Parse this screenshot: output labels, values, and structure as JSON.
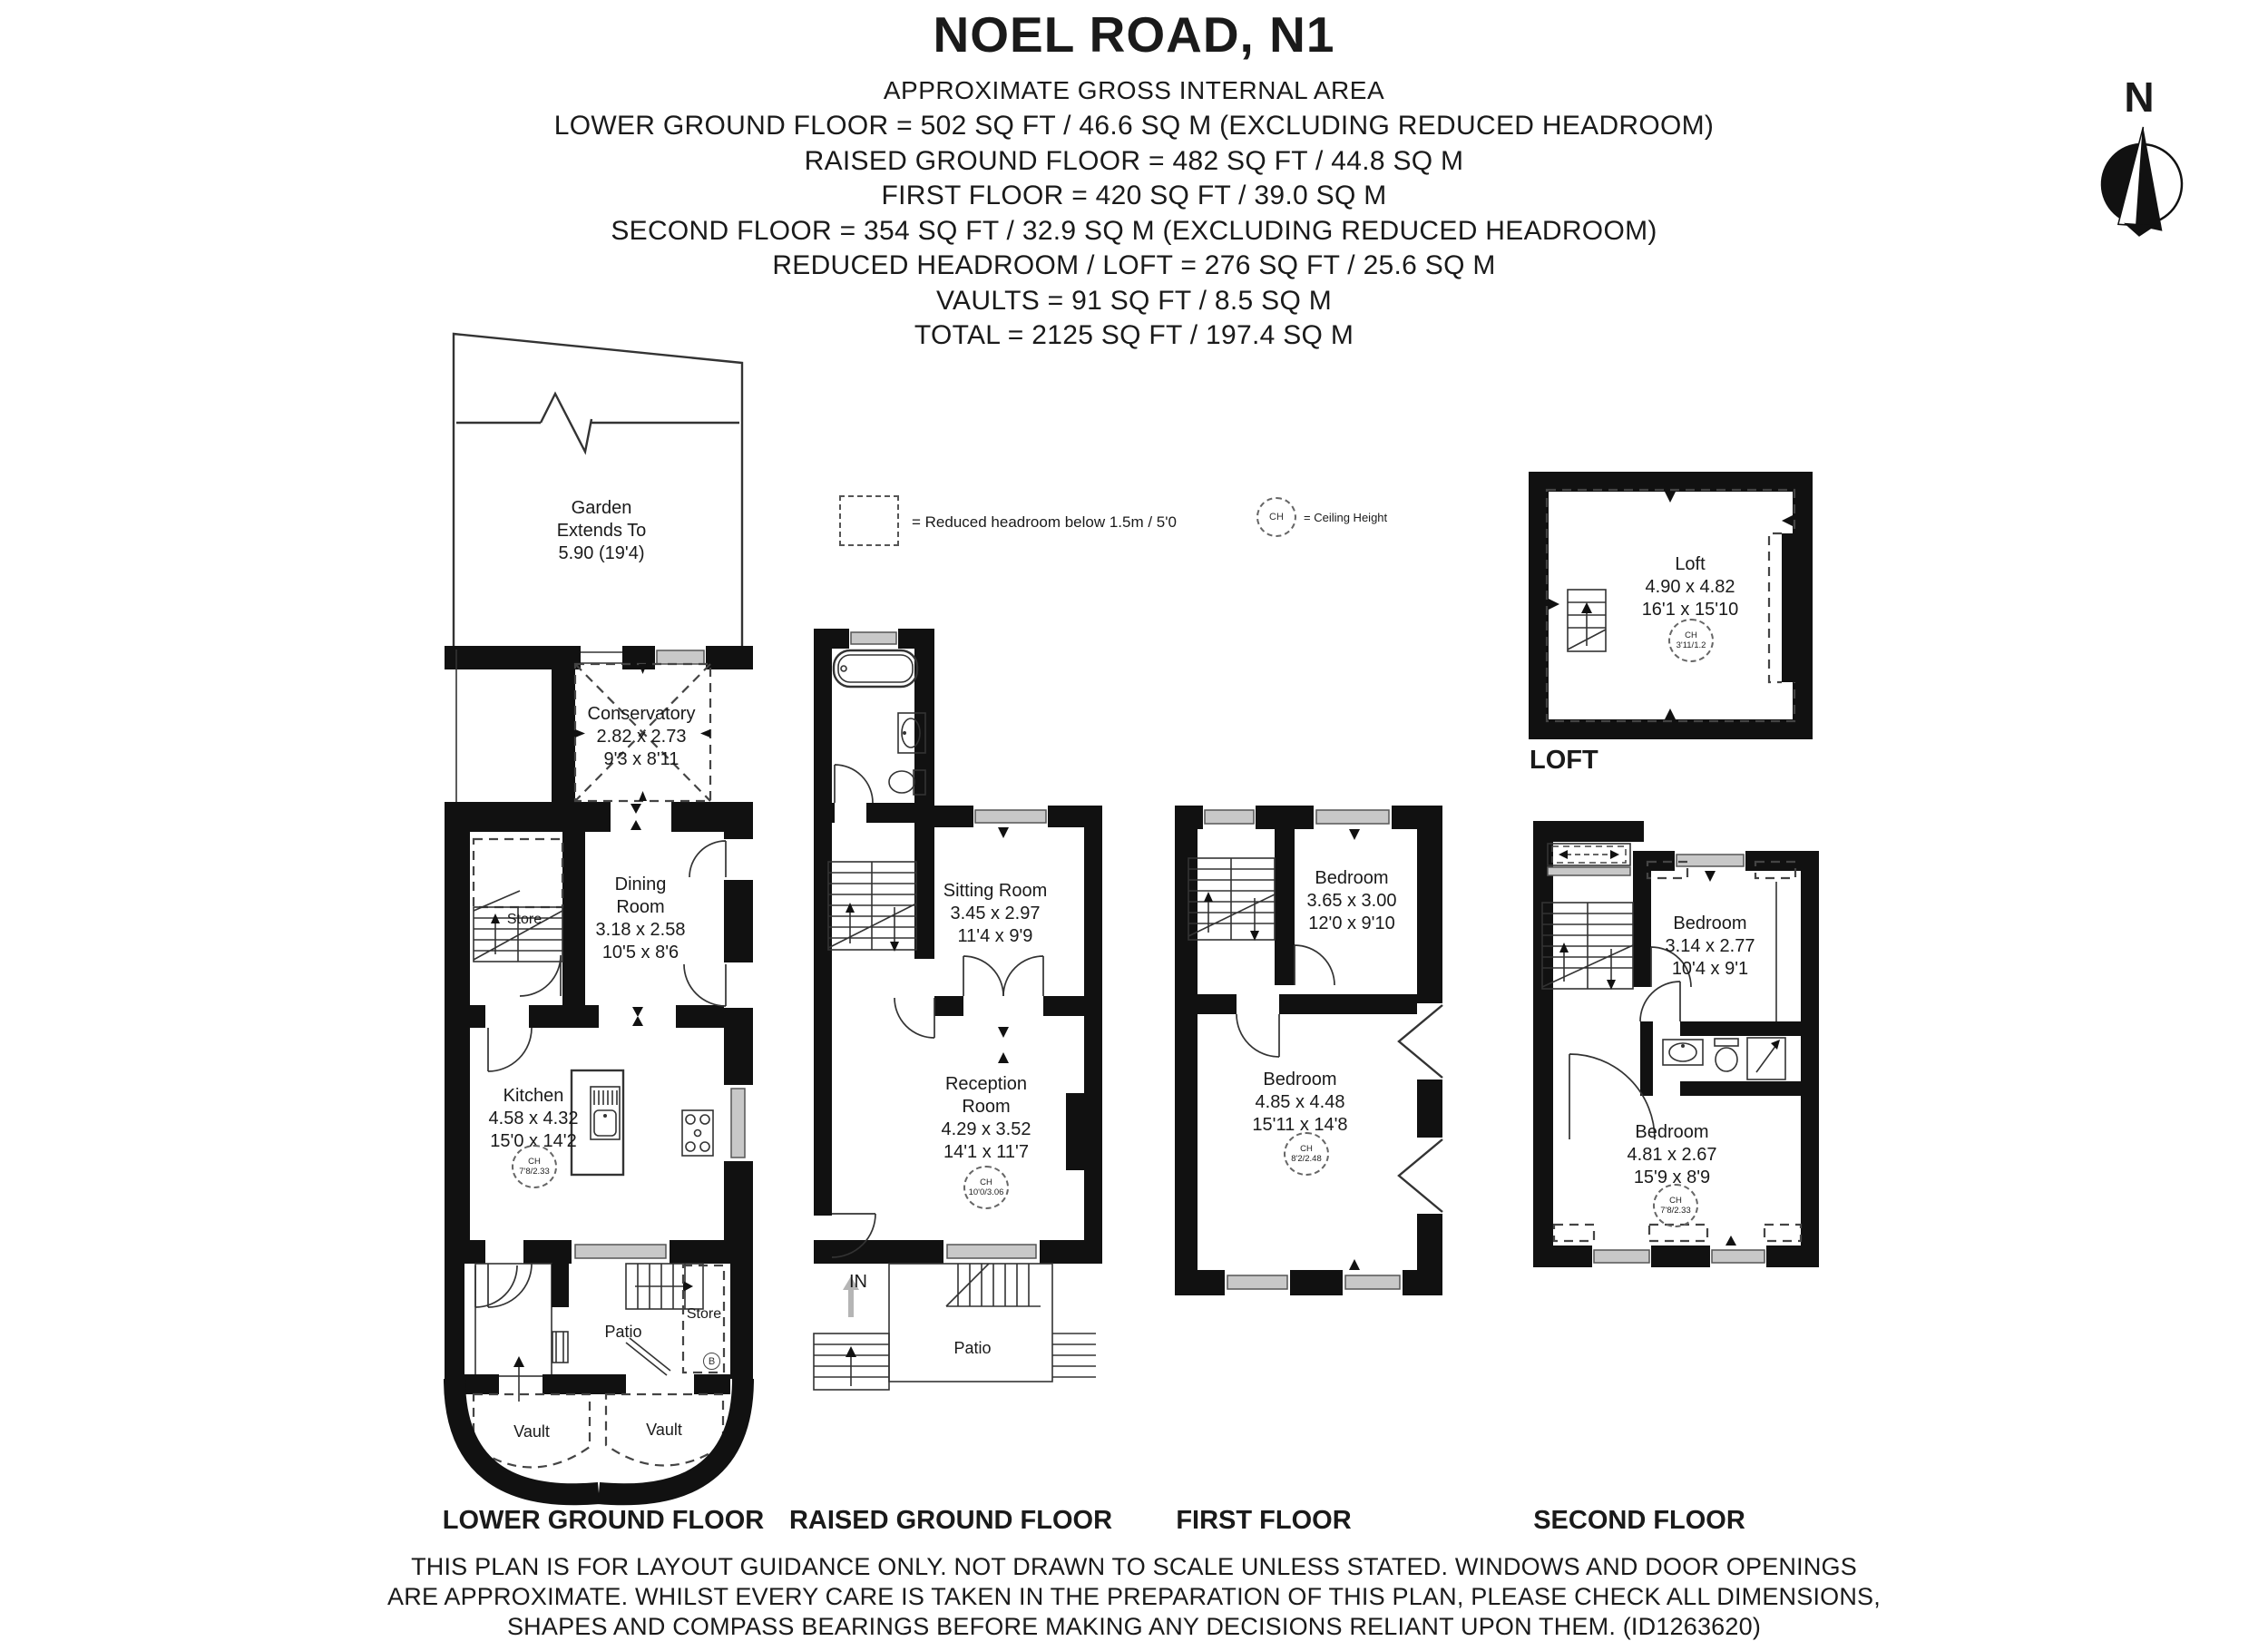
{
  "header": {
    "title": "NOEL ROAD, N1",
    "subtitle": "APPROXIMATE GROSS INTERNAL AREA",
    "lines": [
      "LOWER GROUND FLOOR = 502 SQ FT / 46.6 SQ M (EXCLUDING REDUCED HEADROOM)",
      "RAISED GROUND FLOOR = 482 SQ FT / 44.8 SQ M",
      "FIRST FLOOR = 420 SQ FT / 39.0 SQ M",
      "SECOND FLOOR = 354 SQ FT / 32.9 SQ M (EXCLUDING REDUCED HEADROOM)",
      "REDUCED HEADROOM / LOFT = 276 SQ FT / 25.6 SQ M",
      "VAULTS = 91 SQ FT / 8.5 SQ M",
      "TOTAL = 2125 SQ FT / 197.4 SQ M"
    ]
  },
  "compass": {
    "label": "N"
  },
  "legend": {
    "reduced_headroom": "= Reduced headroom below 1.5m / 5'0",
    "ch_abbr": "CH",
    "ceiling_height": "= Ceiling Height"
  },
  "lower_ground": {
    "floor_label": "LOWER GROUND FLOOR",
    "garden": {
      "line1": "Garden",
      "line2": "Extends To",
      "line3": "5.90 (19'4)"
    },
    "conservatory": {
      "name": "Conservatory",
      "metric": "2.82 x 2.73",
      "imperial": "9'3 x 8'11"
    },
    "dining": {
      "name1": "Dining",
      "name2": "Room",
      "metric": "3.18 x 2.58",
      "imperial": "10'5 x 8'6"
    },
    "store_upper": "Store",
    "kitchen": {
      "name": "Kitchen",
      "metric": "4.58 x 4.32",
      "imperial": "15'0 x 14'2",
      "ch": "7'8/2.33"
    },
    "patio": "Patio",
    "store_lower": "Store",
    "store_lower_badge": "B",
    "vault_left": "Vault",
    "vault_right": "Vault"
  },
  "raised_ground": {
    "floor_label": "RAISED GROUND FLOOR",
    "sitting": {
      "name": "Sitting Room",
      "metric": "3.45 x 2.97",
      "imperial": "11'4 x 9'9"
    },
    "reception": {
      "name1": "Reception",
      "name2": "Room",
      "metric": "4.29 x 3.52",
      "imperial": "14'1 x 11'7",
      "ch": "10'0/3.06"
    },
    "in_label": "IN",
    "patio": "Patio"
  },
  "first_floor": {
    "floor_label": "FIRST FLOOR",
    "bedroom_rear": {
      "name": "Bedroom",
      "metric": "3.65 x 3.00",
      "imperial": "12'0 x 9'10"
    },
    "bedroom_front": {
      "name": "Bedroom",
      "metric": "4.85 x 4.48",
      "imperial": "15'11 x 14'8",
      "ch": "8'2/2.48"
    }
  },
  "second_floor": {
    "floor_label": "SECOND FLOOR",
    "bedroom_rear": {
      "name": "Bedroom",
      "metric": "3.14 x 2.77",
      "imperial": "10'4 x 9'1"
    },
    "bedroom_front": {
      "name": "Bedroom",
      "metric": "4.81 x 2.67",
      "imperial": "15'9 x 8'9",
      "ch": "7'8/2.33"
    }
  },
  "loft": {
    "floor_label": "LOFT",
    "room": {
      "name": "Loft",
      "metric": "4.90 x 4.82",
      "imperial": "16'1 x 15'10",
      "ch": "3'11/1.2"
    }
  },
  "footer": {
    "line1": "THIS PLAN IS FOR LAYOUT GUIDANCE ONLY. NOT DRAWN TO SCALE UNLESS STATED. WINDOWS AND DOOR OPENINGS",
    "line2": "ARE APPROXIMATE. WHILST EVERY CARE IS TAKEN IN THE PREPARATION OF THIS PLAN, PLEASE CHECK ALL DIMENSIONS,",
    "line3": "SHAPES AND COMPASS BEARINGS BEFORE MAKING ANY DECISIONS RELIANT UPON THEM. (ID1263620)"
  },
  "colors": {
    "ink": "#111111",
    "window_fill": "#c8c8c8"
  }
}
